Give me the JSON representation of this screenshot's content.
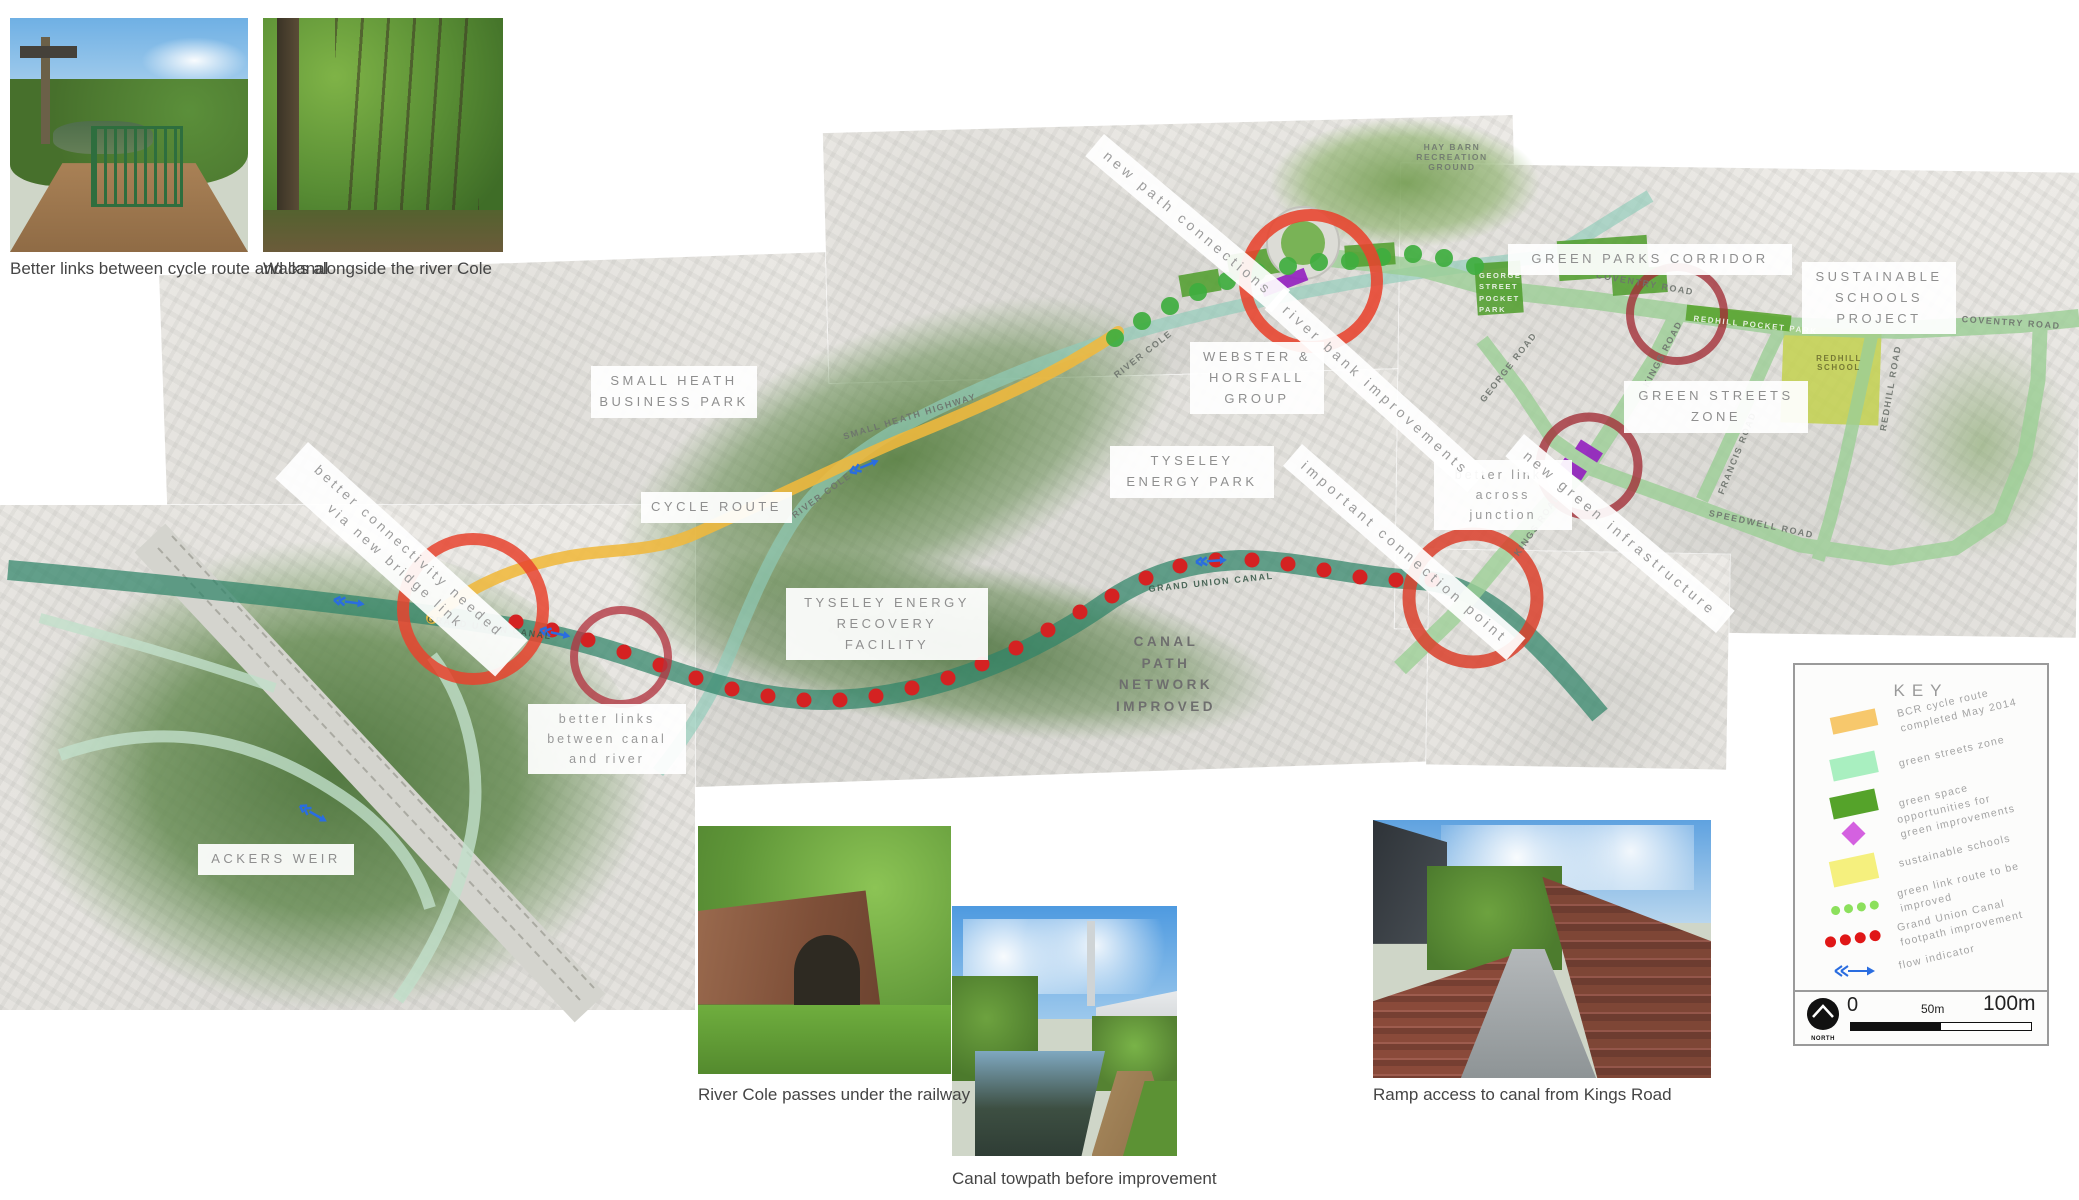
{
  "photos": {
    "top": [
      {
        "caption": "Better links between cycle route and canal"
      },
      {
        "caption": "Walks alongside the river Cole"
      }
    ],
    "bottom": [
      {
        "caption": "River Cole passes under the railway"
      },
      {
        "caption": "Canal towpath before improvement"
      },
      {
        "caption": "Ramp access to canal from Kings Road"
      }
    ]
  },
  "map": {
    "place_labels": {
      "small_heath_business_park": "SMALL HEATH BUSINESS PARK",
      "cycle_route": "CYCLE ROUTE",
      "webster_horsfall_group": "WEBSTER & HORSFALL GROUP",
      "tyseley_energy_park": "TYSELEY ENERGY PARK",
      "tyseley_energy_recovery_facility": "TYSELEY ENERGY RECOVERY FACILITY",
      "canal_path_network_improved": "CANAL PATH NETWORK IMPROVED",
      "green_parks_corridor": "GREEN PARKS CORRIDOR",
      "sustainable_schools_project": "SUSTAINABLE SCHOOLS PROJECT",
      "green_streets_zone": "GREEN STREETS ZONE",
      "ackers_weir": "ACKERS WEIR"
    },
    "annotations": {
      "new_path_connections": "new path connections",
      "river_bank_improvements": "river bank improvements",
      "better_connectivity": "better connectivity needed via new bridge link",
      "important_connection_point": "important connection point",
      "better_links_across_junction": "better links across junction",
      "better_links_canal_river": "better links between canal and river",
      "new_green_infrastructure": "new green infrastructure"
    },
    "road_labels": {
      "coventry_road": "COVENTRY ROAD",
      "kings_road": "KINGS ROAD",
      "francis_road": "FRANCIS ROAD",
      "speedwell_road": "SPEEDWELL ROAD",
      "redhill_road": "REDHILL ROAD",
      "george_road": "GEORGE ROAD",
      "small_heath_highway": "SMALL HEATH HIGHWAY",
      "river_cole": "RIVER COLE",
      "grand_union_canal": "GRAND UNION CANAL",
      "hay_barn_recreation_ground": "HAY BARN RECREATION GROUND",
      "redhill_pocket_park": "REDHILL POCKET PARK",
      "george_street_pocket_park": "GEORGE STREET POCKET PARK",
      "redhill_school": "REDHILL SCHOOL"
    },
    "colors": {
      "cycle_route_orange": "#f0b83c",
      "canal_teal": "#2f8468",
      "green_streets_band": "#9ccf96",
      "green_space": "#4f9e2b",
      "green_improvement_purple": "#941fc0",
      "green_link_dots": "#3fae3f",
      "canal_footpath_dots": "#d42222",
      "highlight_circle_red": "#e8432e",
      "highlight_circle_dark_red": "#a23038",
      "flow_arrow_blue": "#2a6de0"
    }
  },
  "key": {
    "title": "KEY",
    "items": [
      {
        "label": "BCR cycle route completed May 2014",
        "color": "#f7c86c",
        "swatch": "orange-bar"
      },
      {
        "label": "green streets zone",
        "color": "#a9efc0",
        "swatch": "lightgreen-bar"
      },
      {
        "label": "green space",
        "color": "#55a32a",
        "swatch": "darkgreen-bar"
      },
      {
        "label": "opportunities for green improvements",
        "color": "#d461e0",
        "swatch": "magenta-diamond"
      },
      {
        "label": "sustainable schools",
        "color": "#f5f07e",
        "swatch": "yellow-bar"
      },
      {
        "label": "green link route to be improved",
        "color": "#8ce05c",
        "swatch": "green-dots"
      },
      {
        "label": "Grand Union Canal footpath improvement",
        "color": "#e01717",
        "swatch": "red-dots"
      },
      {
        "label": "flow indicator",
        "color": "#2a6de0",
        "swatch": "blue-arrow"
      }
    ],
    "scale": {
      "zero": "0",
      "mid": "50m",
      "max": "100m",
      "north_label": "NORTH"
    }
  }
}
